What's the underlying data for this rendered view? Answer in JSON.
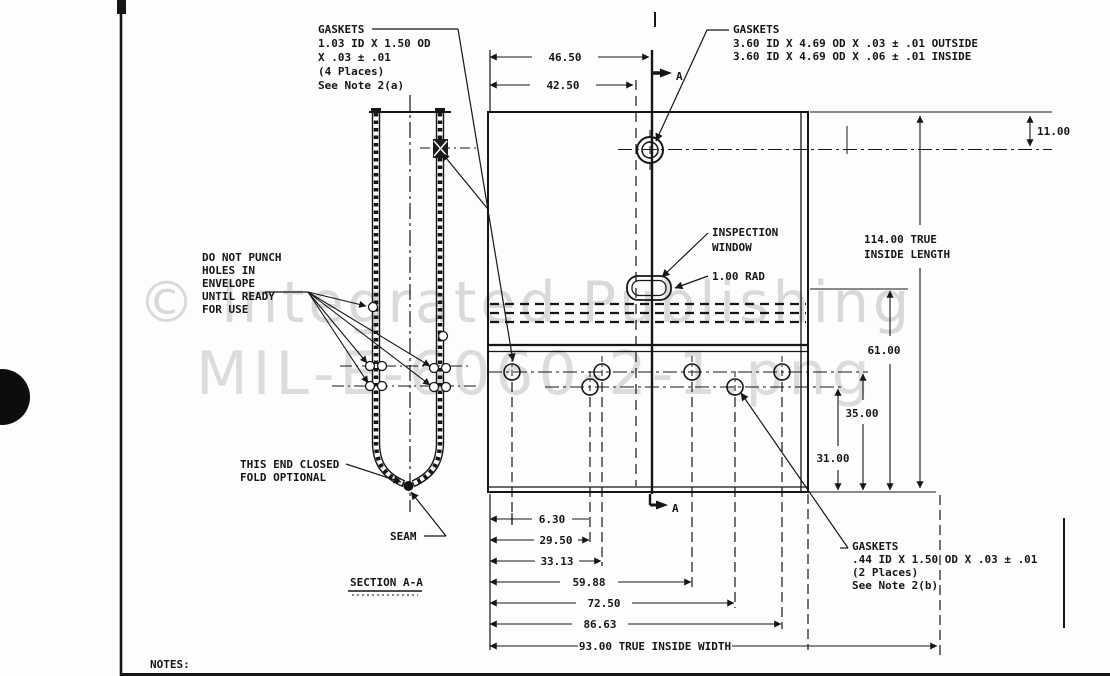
{
  "watermark": {
    "line1": "© Integrated Publishing",
    "line2": "MIL-E-6060-2-1.png"
  },
  "labels": {
    "gaskets_top_left": [
      "GASKETS",
      "1.03 ID X 1.50 OD",
      "X .03 ± .01",
      "(4 Places)",
      "See Note 2(a)"
    ],
    "gaskets_top_right": [
      "GASKETS",
      "3.60 ID X 4.69 OD X .03 ± .01 OUTSIDE",
      "3.60 ID X 4.69 OD X .06 ± .01 INSIDE"
    ],
    "gaskets_bottom_right": [
      "GASKETS",
      ".44 ID X 1.50 OD X .03 ± .01",
      "(2 Places)",
      "See Note 2(b)"
    ],
    "do_not_punch": [
      "DO NOT PUNCH",
      "HOLES IN",
      "ENVELOPE",
      "UNTIL READY",
      "FOR USE"
    ],
    "this_end_closed": [
      "THIS END CLOSED",
      "FOLD OPTIONAL"
    ],
    "seam": "SEAM",
    "inspection_window": [
      "INSPECTION",
      "WINDOW"
    ],
    "radius_callout": "1.00 RAD",
    "section_title": "SECTION A-A",
    "section_marker": "A",
    "notes": "NOTES:"
  },
  "dimensions": {
    "top": {
      "d1": "46.50",
      "d2": "42.50"
    },
    "right": {
      "r1": "11.00",
      "r2a": "114.00 TRUE",
      "r2b": "INSIDE LENGTH",
      "r3": "61.00",
      "r4": "35.00",
      "r5": "31.00"
    },
    "bottom": {
      "b1": "6.30",
      "b2": "29.50",
      "b3": "33.13",
      "b4": "59.88",
      "b5": "72.50",
      "b6": "86.63",
      "b7": "93.00 TRUE INSIDE WIDTH"
    }
  }
}
